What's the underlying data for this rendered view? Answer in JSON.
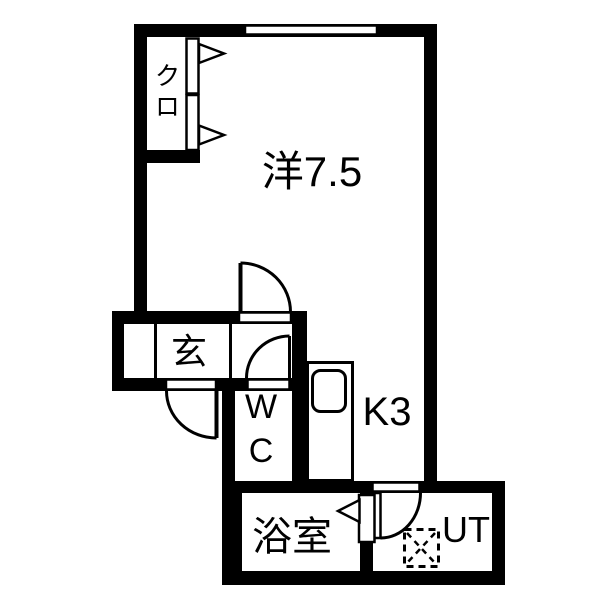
{
  "plan": {
    "name": "apartment-floor-plan",
    "rooms": [
      {
        "id": "closet",
        "label": "クロ"
      },
      {
        "id": "western-room",
        "label": "洋7.5"
      },
      {
        "id": "entrance",
        "label": "玄"
      },
      {
        "id": "toilet",
        "label": "WC"
      },
      {
        "id": "kitchen",
        "label": "K3"
      },
      {
        "id": "bathroom",
        "label": "浴室"
      },
      {
        "id": "utility",
        "label": "UT"
      }
    ],
    "colors": {
      "wall": "#000000",
      "floor": "#ffffff",
      "line": "#000000"
    }
  }
}
